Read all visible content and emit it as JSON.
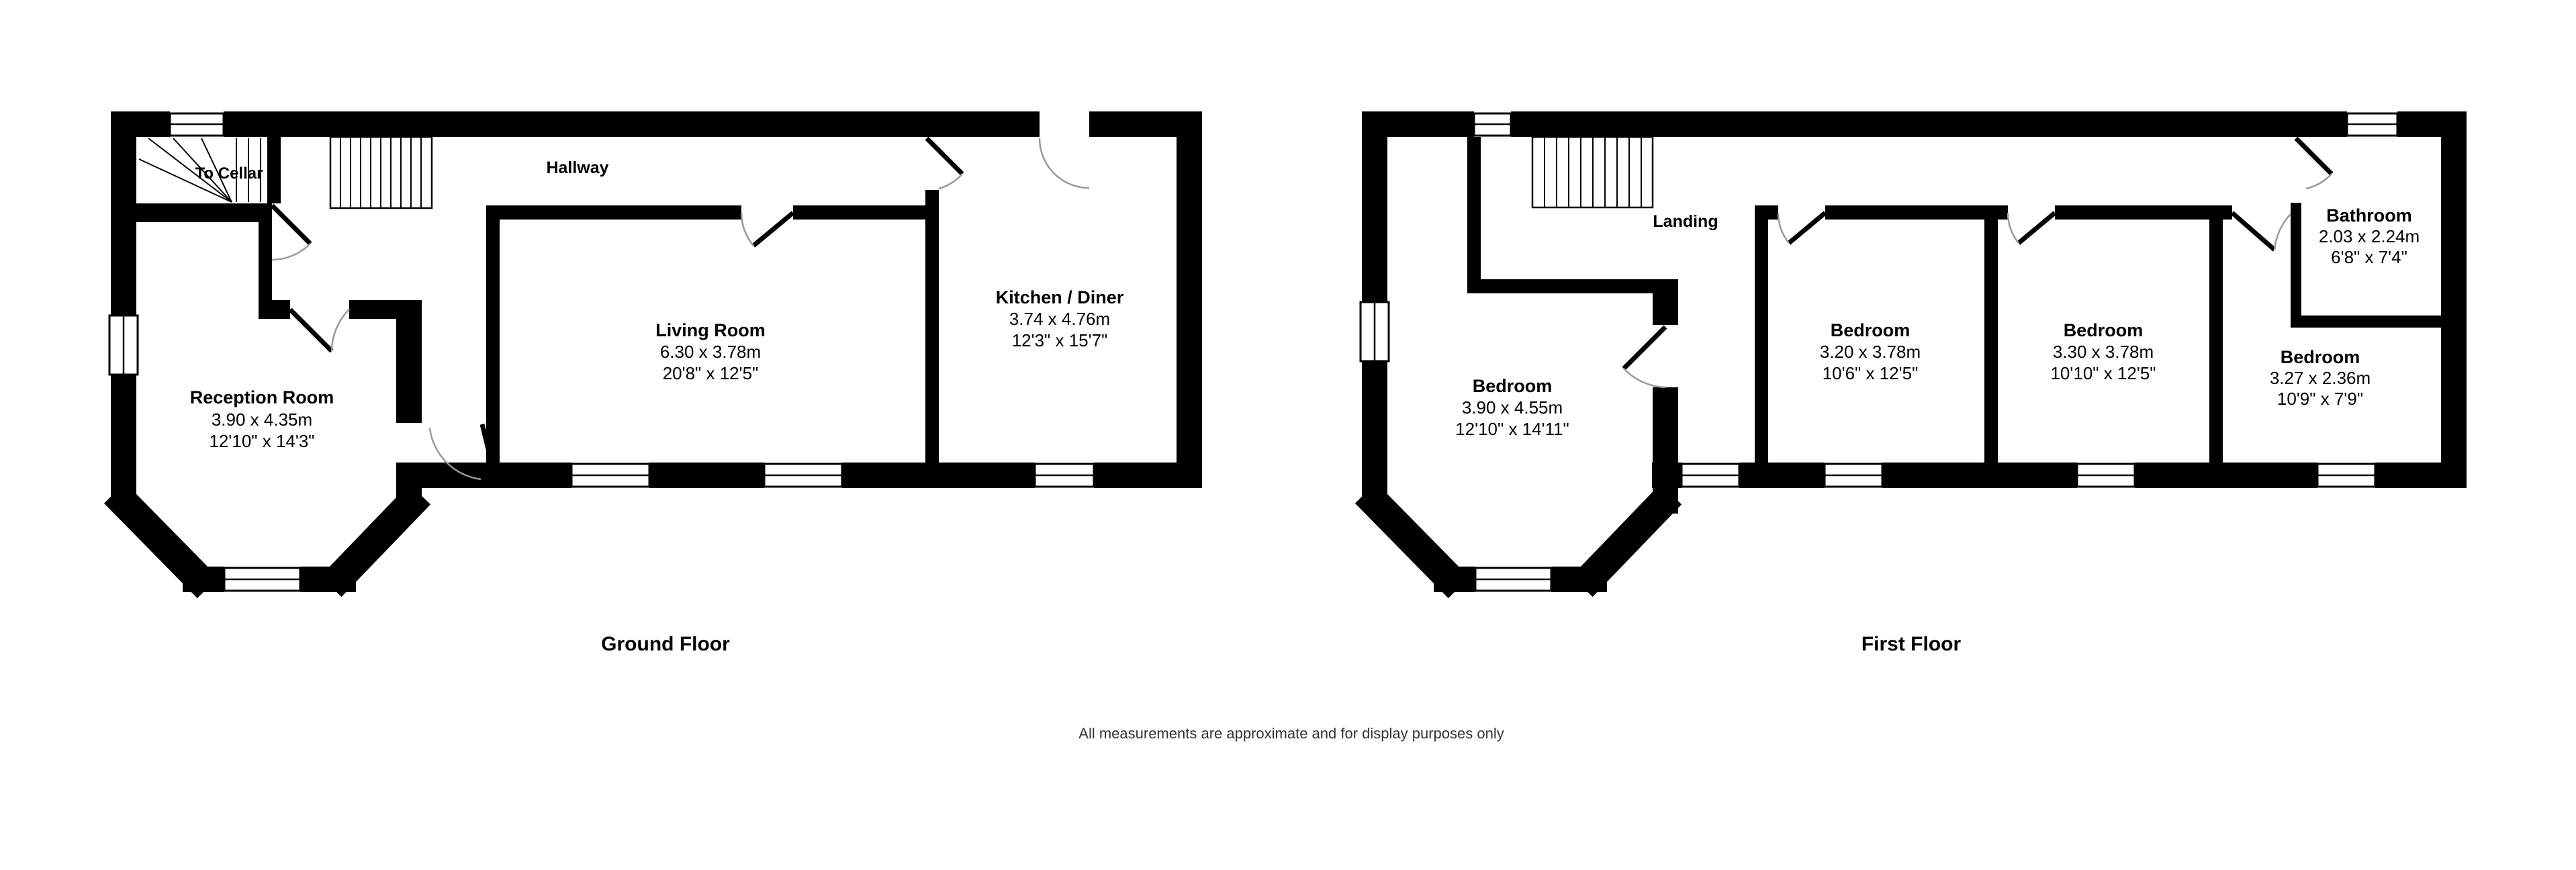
{
  "ground_floor": {
    "title": "Ground Floor",
    "labels": {
      "to_cellar": "To Cellar",
      "hallway": "Hallway"
    },
    "rooms": [
      {
        "name": "Reception Room",
        "metric": "3.90 x 4.35m",
        "imperial": "12'10\" x 14'3\""
      },
      {
        "name": "Living Room",
        "metric": "6.30 x 3.78m",
        "imperial": "20'8\" x 12'5\""
      },
      {
        "name": "Kitchen / Diner",
        "metric": "3.74 x 4.76m",
        "imperial": "12'3\" x 15'7\""
      }
    ]
  },
  "first_floor": {
    "title": "First Floor",
    "labels": {
      "landing": "Landing"
    },
    "rooms": [
      {
        "name": "Bedroom",
        "metric": "3.90 x 4.55m",
        "imperial": "12'10\" x 14'11\""
      },
      {
        "name": "Bedroom",
        "metric": "3.20 x 3.78m",
        "imperial": "10'6\" x 12'5\""
      },
      {
        "name": "Bedroom",
        "metric": "3.30 x 3.78m",
        "imperial": "10'10\" x 12'5\""
      },
      {
        "name": "Bathroom",
        "metric": "2.03 x 2.24m",
        "imperial": "6'8\" x 7'4\""
      },
      {
        "name": "Bedroom",
        "metric": "3.27 x 2.36m",
        "imperial": "10'9\" x 7'9\""
      }
    ]
  },
  "footer": {
    "disclaimer": "All measurements are approximate and for display purposes only"
  },
  "colors": {
    "wall": "#000000",
    "background": "#ffffff",
    "door_arc": "#999999"
  }
}
